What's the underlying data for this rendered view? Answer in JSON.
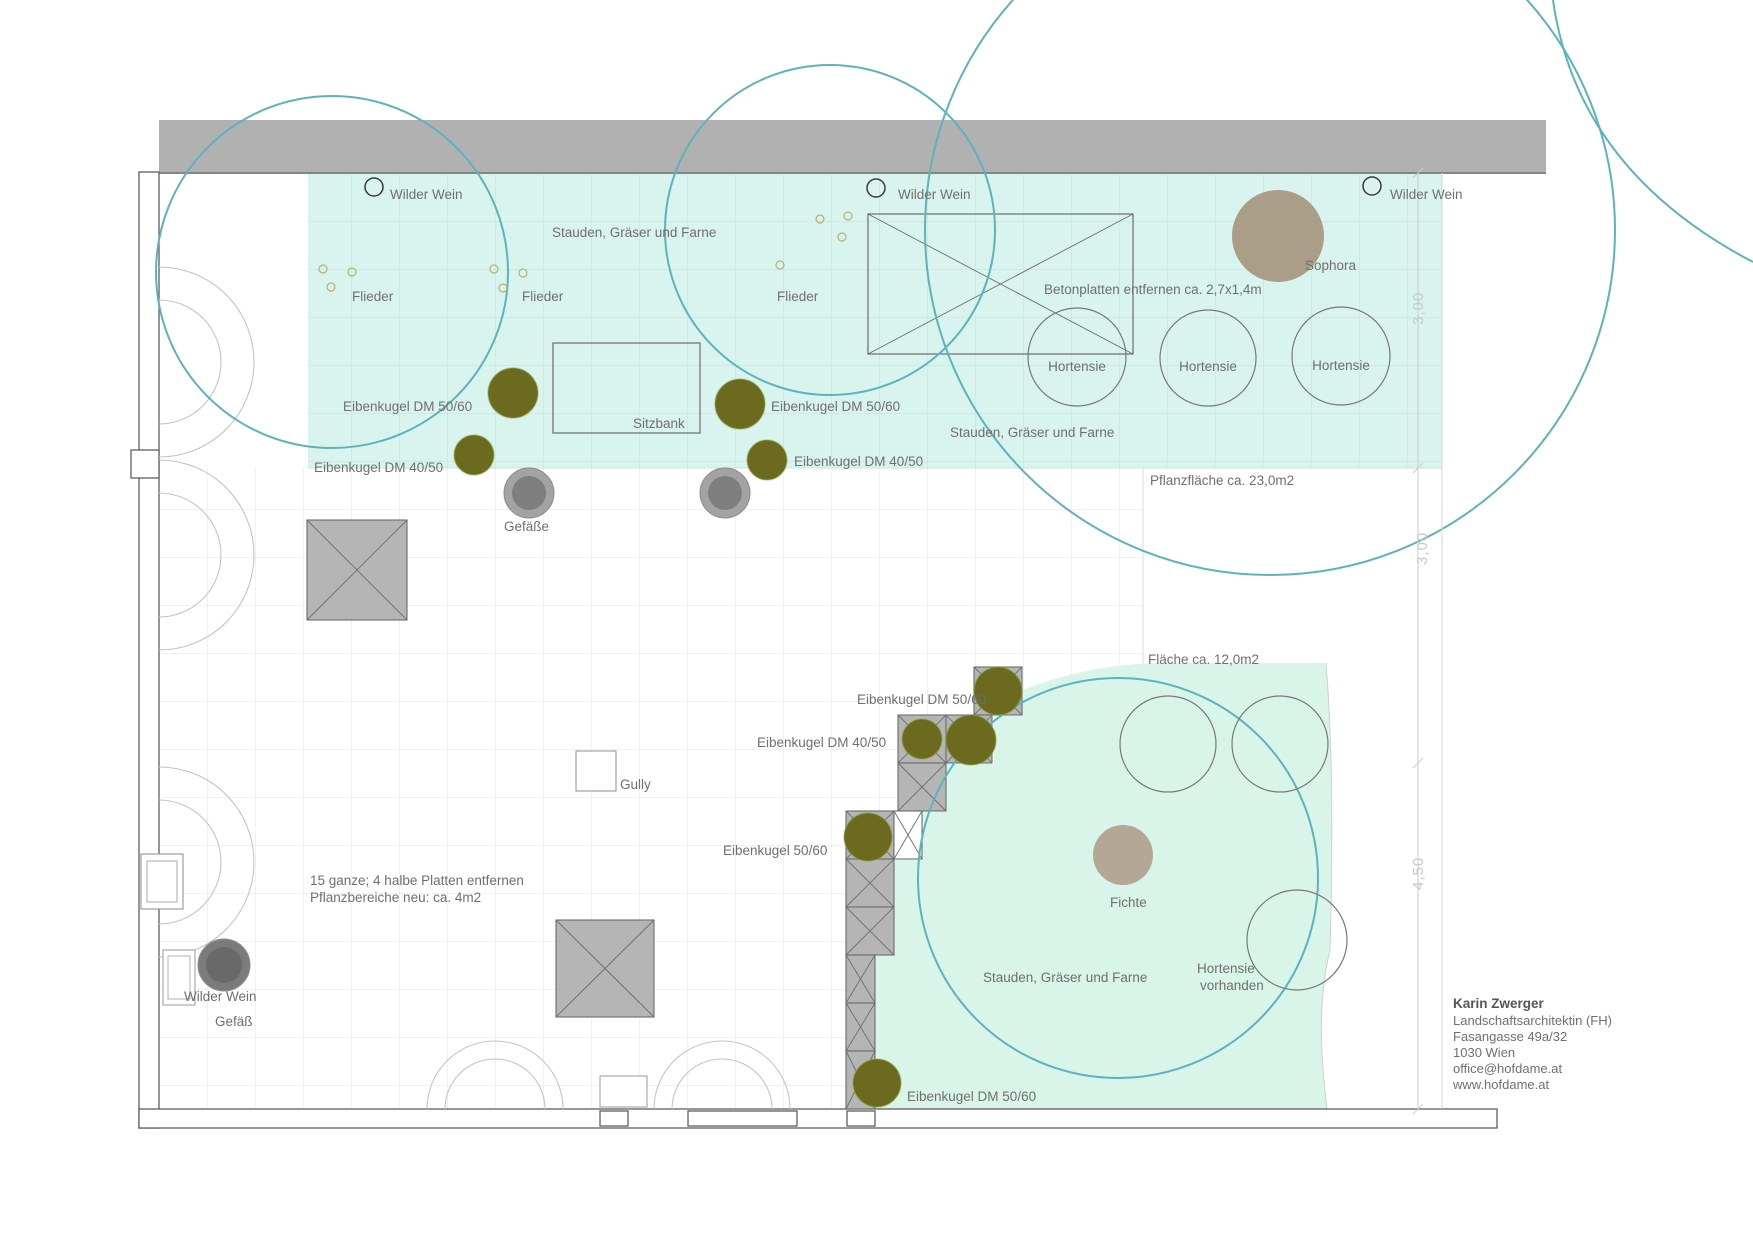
{
  "plan": {
    "type": "landscape-architecture-plan",
    "labels": {
      "wilder_wein": "Wilder Wein",
      "stauden": "Stauden, Gräser und Farne",
      "flieder": "Flieder",
      "eibenkugel_dm_5060": "Eibenkugel DM 50/60",
      "eibenkugel_dm_4050": "Eibenkugel DM 40/50",
      "eibenkugel_5060": "Eibenkugel 50/60",
      "sitzbank": "Sitzbank",
      "gefaesse": "Gefäße",
      "gefaess": "Gefäß",
      "gully": "Gully",
      "sophora": "Sophora",
      "hortensie": "Hortensie",
      "hortensie_vorhanden_line1": "Hortensie",
      "hortensie_vorhanden_line2": "vorhanden",
      "fichte": "Fichte",
      "betonplatten_note": "Betonplatten entfernen ca. 2,7x1,4m",
      "pflanzflaeche_note": "Pflanzfläche ca. 23,0m2",
      "flaeche_note": "Fläche ca. 12,0m2",
      "platten_note_line1": "15 ganze; 4 halbe Platten entfernen",
      "platten_note_line2": "Pflanzbereiche neu: ca. 4m2"
    },
    "dimensions": {
      "dim_top": "3,00",
      "dim_middle": "3,00",
      "dim_bottom": "4,50"
    },
    "credits": {
      "name": "Karin Zwerger",
      "title": "Landschaftsarchitektin (FH)",
      "street": "Fasangasse 49a/32",
      "city": "1030 Wien",
      "email": "office@hofdame.at",
      "web": "www.hofdame.at"
    },
    "colors": {
      "planting_area_top": "#d9f4ee",
      "planting_area_bottom": "#d9f5e9",
      "grid_cyan": "#aeeae4",
      "grid_paver": "#e3e3e3",
      "tree_crown_teal": "#5cb2bd",
      "eibenkugel_olive": "#6b6a1e",
      "tree_brown": "#ab9e89",
      "platten_gray": "#b5b5b5",
      "wall_gray": "#b1b1b1",
      "pot_gray": "#a3a3a3",
      "label_gray": "#6f6f6f",
      "dimension_gray": "#c8c8c8"
    }
  }
}
